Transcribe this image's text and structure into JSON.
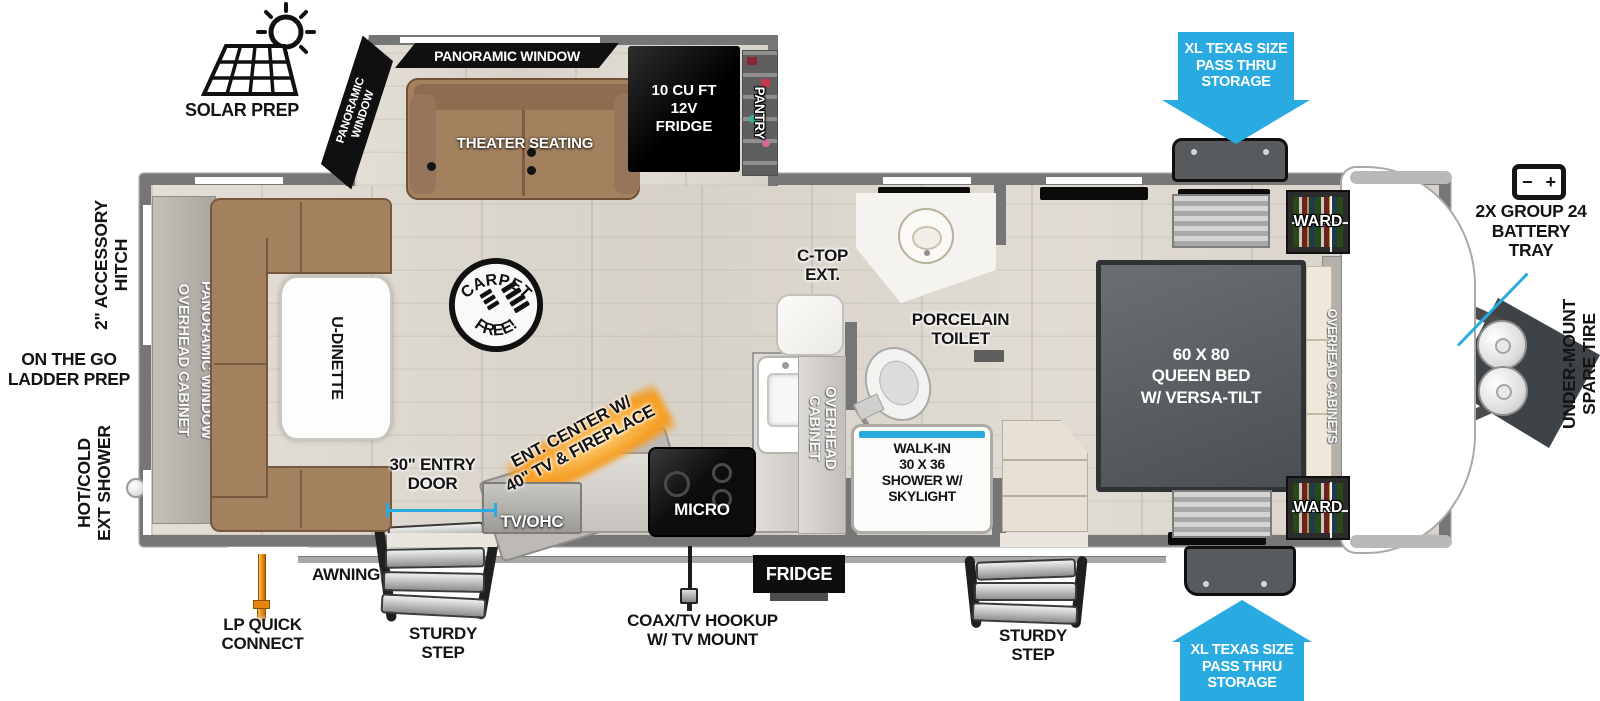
{
  "title": "Travel Trailer Floorplan",
  "colors": {
    "accent_blue": "#29abe2",
    "wall_gray": "#767676",
    "sofa_brown": "#a3815f",
    "bed_gray": "#54585b",
    "fireplace_orange": "#f59a1d"
  },
  "exterior": {
    "solar_prep": "SOLAR PREP",
    "pass_thru": "XL TEXAS SIZE\nPASS THRU\nSTORAGE",
    "battery_icon_minus": "−",
    "battery_icon_plus": "+",
    "battery_tray": "2X GROUP 24\nBATTERY\nTRAY",
    "under_mount_spare_tire": "UNDER-MOUNT\nSPARE TIRE",
    "accessory_hitch": "2\" ACCESSORY\nHITCH",
    "ladder_prep": "ON THE GO\nLADDER PREP",
    "ext_shower": "HOT/COLD\nEXT SHOWER",
    "lp_quick_connect": "LP QUICK\nCONNECT",
    "awning": "AWNING",
    "sturdy_step": "STURDY\nSTEP",
    "coax": "COAX/TV HOOKUP\nW/ TV MOUNT",
    "entry_door": "30\" ENTRY\nDOOR",
    "fridge_vent": "FRIDGE"
  },
  "interior": {
    "panoramic_window": "PANORAMIC WINDOW",
    "panoramic_window_2line": "PANORAMIC\nWINDOW",
    "theater_seating": "THEATER SEATING",
    "fridge_12v": "10 CU FT\n12V\nFRIDGE",
    "pantry": "PANTRY",
    "carpet_free_top": "CARPET",
    "carpet_free_bottom": "FREE!",
    "ent_center": "ENT. CENTER W/\n40\" TV & FIREPLACE",
    "tv_ohc": "TV/OHC",
    "micro": "MICRO",
    "overhead_cabinet_2line": "OVERHEAD\nCABINET",
    "ctop_ext": "C-TOP\nEXT.",
    "porcelain_toilet": "PORCELAIN\nTOILET",
    "shower": "WALK-IN\n30 X 36\nSHOWER W/\nSKYLIGHT",
    "u_dinette": "U-DINETTE",
    "overhead_cabinet": "OVERHEAD CABINET",
    "queen_bed": "60 X 80\nQUEEN BED\nW/ VERSA-TILT",
    "ward": "WARD",
    "overhead_cabinets": "OVERHEAD CABINETS"
  }
}
